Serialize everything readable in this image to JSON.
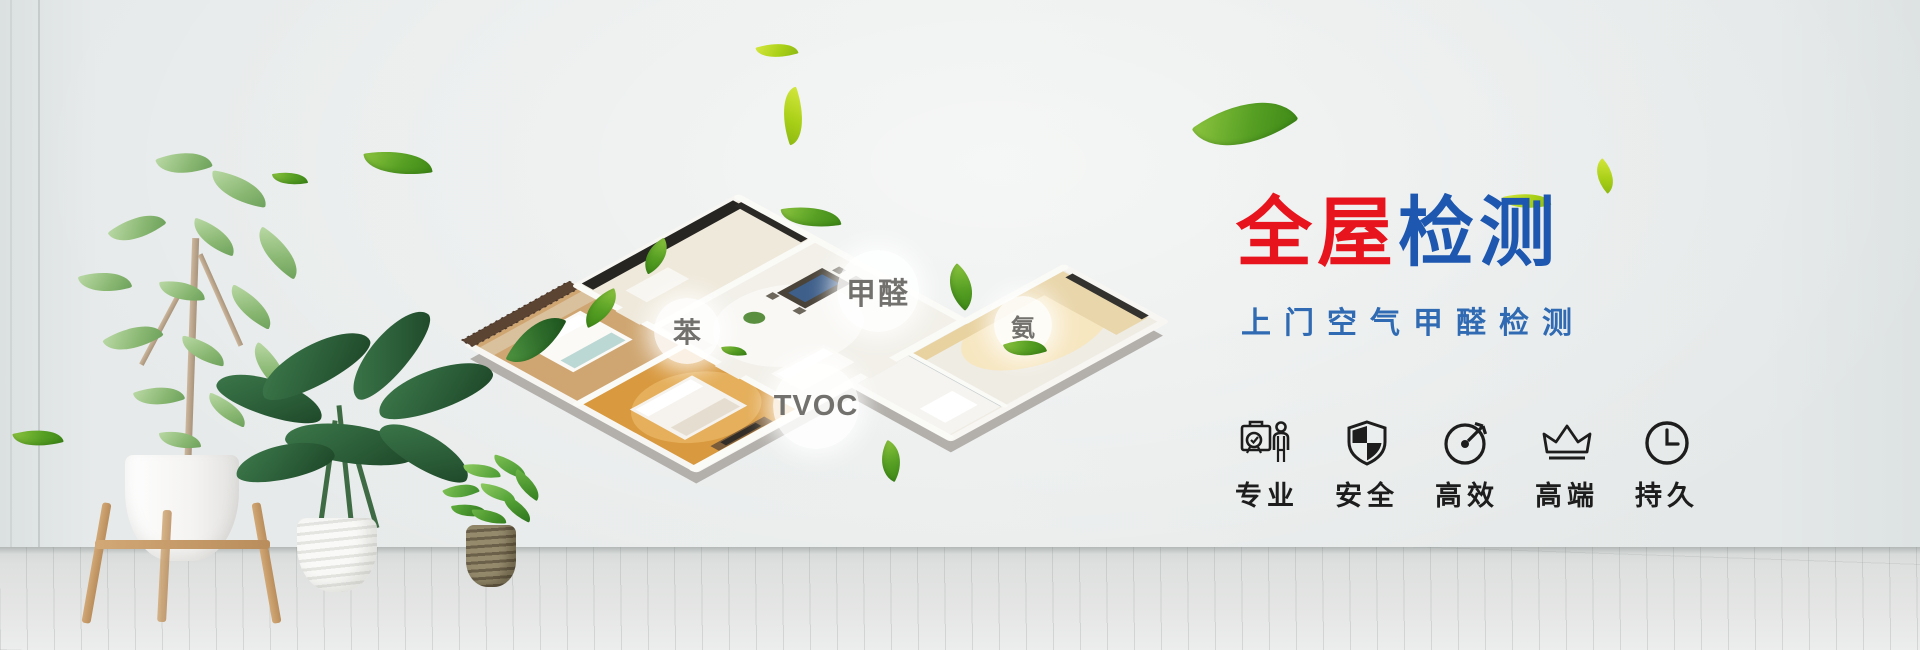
{
  "banner": {
    "title_part1": "全屋",
    "title_part2": "检测",
    "subtitle": "上门空气甲醛检测",
    "colors": {
      "title_red": "#e8141d",
      "title_blue": "#1d57b0",
      "subtitle_blue": "#2f6ab2",
      "icon_black": "#1d1d1d",
      "leaf_green": "#57a024",
      "leaf_light_green": "#a8cf17",
      "wall_gray": "#e7eaea",
      "floor_gray": "#dee0df"
    }
  },
  "house_labels": [
    {
      "id": "benzene",
      "text": "苯"
    },
    {
      "id": "formaldehyde",
      "text": "甲醛"
    },
    {
      "id": "ammonia",
      "text": "氨"
    },
    {
      "id": "tvoc",
      "text": "TVOC"
    }
  ],
  "features": [
    {
      "icon": "certificate-person-icon",
      "label": "专业"
    },
    {
      "icon": "shield-icon",
      "label": "安全"
    },
    {
      "icon": "gauge-icon",
      "label": "高效"
    },
    {
      "icon": "crown-icon",
      "label": "高端"
    },
    {
      "icon": "clock-icon",
      "label": "持久"
    }
  ]
}
